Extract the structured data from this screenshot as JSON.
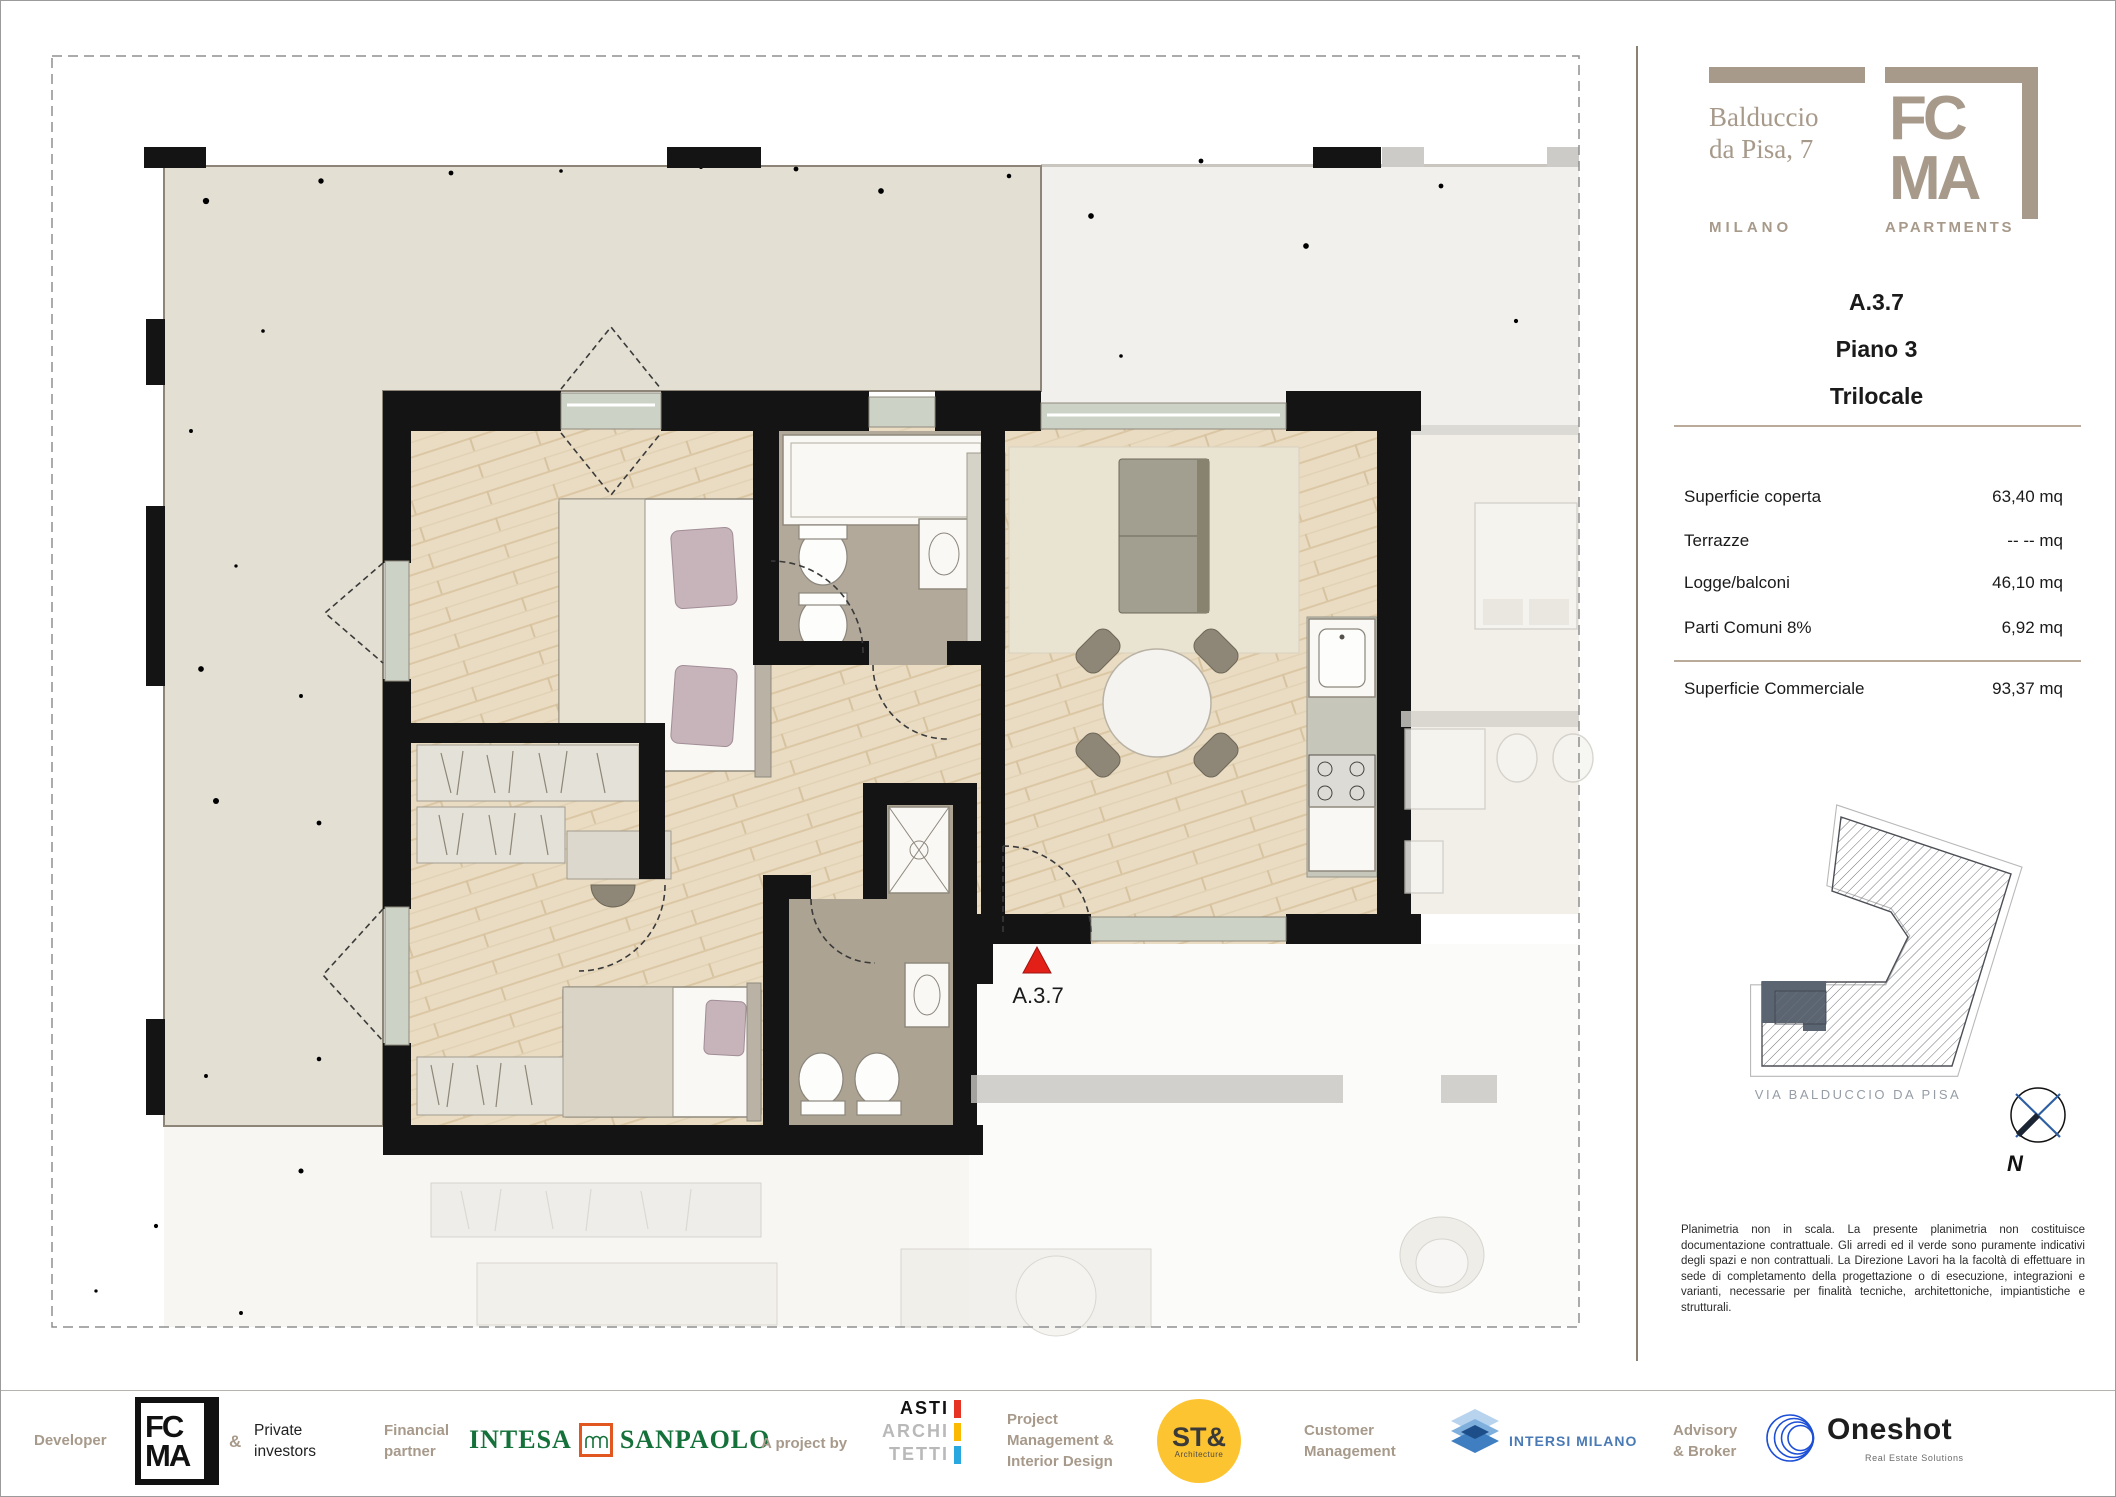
{
  "brand": {
    "street_line1": "Balduccio",
    "street_line2": "da Pisa, 7",
    "city": "MILANO",
    "mark_top": "FC",
    "mark_bottom": "MA",
    "mark_word": "APARTMENTS"
  },
  "unit": {
    "code": "A.3.7",
    "floor": "Piano 3",
    "type": "Trilocale"
  },
  "areas": {
    "rows": [
      {
        "label": "Superficie coperta",
        "value": "63,40 mq"
      },
      {
        "label": "Terrazze",
        "value": "-- --  mq"
      },
      {
        "label": "Logge/balconi",
        "value": "46,10 mq"
      },
      {
        "label": "Parti Comuni 8%",
        "value": "6,92 mq"
      }
    ],
    "total": {
      "label": "Superficie Commerciale",
      "value": "93,37 mq"
    }
  },
  "sitemap": {
    "street": "VIA BALDUCCIO DA PISA",
    "compass": "N"
  },
  "plan": {
    "marker_label": "A.3.7"
  },
  "disclaimer": "Planimetria non in scala. La presente planimetria non costituisce documentazione contrattuale. Gli arredi ed il verde sono puramente indicativi degli spazi e non contrattuali. La Direzione Lavori ha la facoltà di effettuare in sede di completamento della progettazione o di esecuzione, integrazioni e varianti, necessarie per finalità tecniche, architettoniche, impiantistiche e strutturali.",
  "footer": {
    "developer_label": "Developer",
    "developer_logo_top": "FC",
    "developer_logo_bottom": "MA",
    "amp": "&",
    "private_line1": "Private",
    "private_line2": "investors",
    "financial_line1": "Financial",
    "financial_line2": "partner",
    "intesa_left": "INTESA",
    "intesa_right": "SANPAOLO",
    "project_by": "A project by",
    "asti_lines": [
      "ASTI",
      "ARCHI",
      "TETTI"
    ],
    "pm_line1": "Project",
    "pm_line2": "Management &",
    "pm_line3": "Interior Design",
    "st_logo": "ST&",
    "st_sub": "Architecture",
    "customer_line1": "Customer",
    "customer_line2": "Management",
    "intersi_label": "INTERSI MILANO",
    "advisory_line1": "Advisory",
    "advisory_line2": "& Broker",
    "oneshot_label": "Oneshot",
    "oneshot_sub": "Real Estate Solutions"
  }
}
